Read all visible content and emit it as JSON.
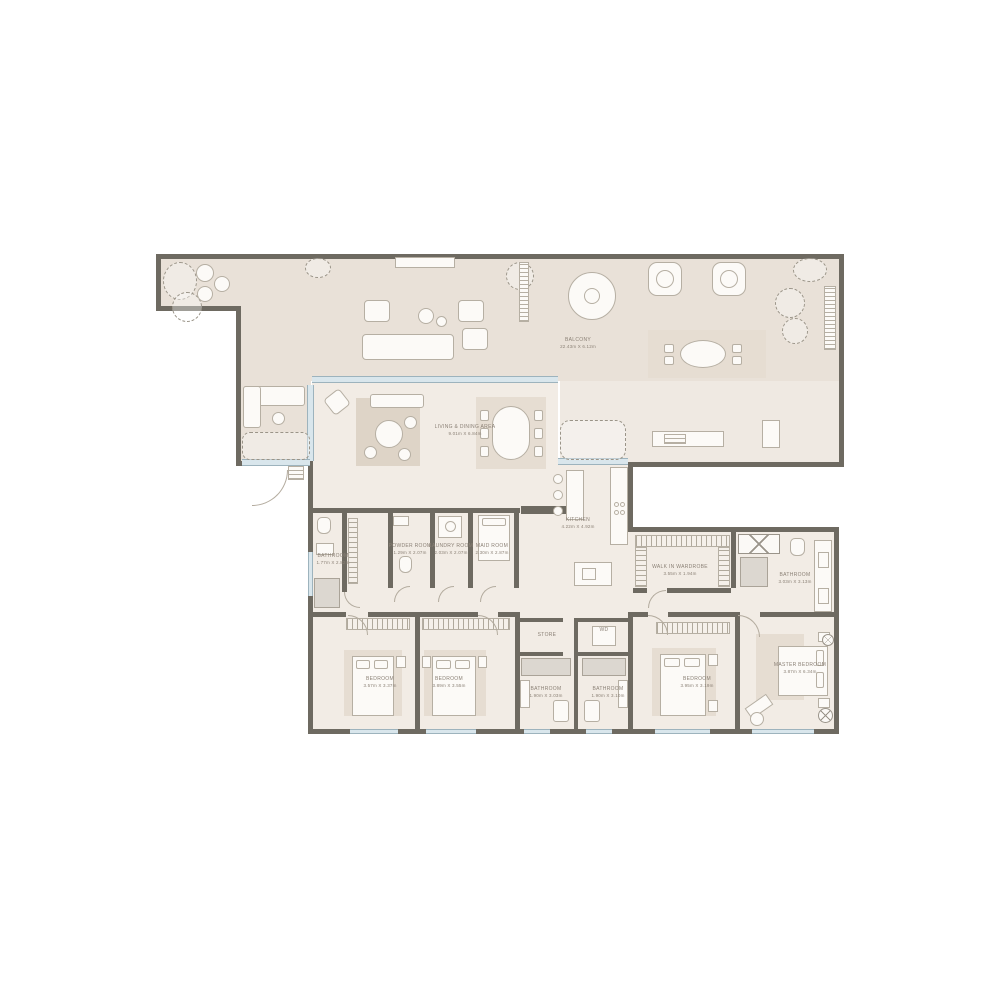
{
  "plan_title": "Apartment Floor Plan",
  "colors": {
    "wall": "#6e6a61",
    "balcony_floor": "#e9e1d8",
    "interior_floor": "#f2ece5",
    "rug": "#ded4c7",
    "glass": "#d9e6ec",
    "label_text": "#8b8176"
  },
  "rooms": {
    "balcony": {
      "name": "BALCONY",
      "dims": "22.43m X 6.12m"
    },
    "living_dining": {
      "name": "LIVING & DINING AREA",
      "dims": "9.01m X 6.84m"
    },
    "kitchen": {
      "name": "KITCHEN",
      "dims": "4.22m X 4.92m"
    },
    "bathroom_left": {
      "name": "BATHROOM",
      "dims": "1.77m X 2.82m"
    },
    "powder_room": {
      "name": "POWDER ROOM",
      "dims": "1.29m X 2.07m"
    },
    "laundry_room": {
      "name": "LAUNDRY ROOM",
      "dims": "2.03m X 2.07m"
    },
    "maid_room": {
      "name": "MAID ROOM",
      "dims": "2.30m X 2.87m"
    },
    "walk_in_wardrobe": {
      "name": "WALK IN WARDROBE",
      "dims": "3.55m X 1.94m"
    },
    "master_bathroom": {
      "name": "BATHROOM",
      "dims": "3.03m X 3.13m"
    },
    "bedroom_1": {
      "name": "BEDROOM",
      "dims": "3.57m X 3.37m"
    },
    "bedroom_2": {
      "name": "BEDROOM",
      "dims": "3.89m X 3.55m"
    },
    "store": {
      "name": "STORE",
      "dims": ""
    },
    "wd": {
      "name": "WD",
      "dims": ""
    },
    "bathroom_center_left": {
      "name": "BATHROOM",
      "dims": "1.90m X 3.03m"
    },
    "bathroom_center_right": {
      "name": "BATHROOM",
      "dims": "1.90m X 3.10m"
    },
    "bedroom_3": {
      "name": "BEDROOM",
      "dims": "3.95m X 3.19m"
    },
    "master_bedroom": {
      "name": "MASTER BEDROOM",
      "dims": "3.87m X 6.34m"
    }
  }
}
